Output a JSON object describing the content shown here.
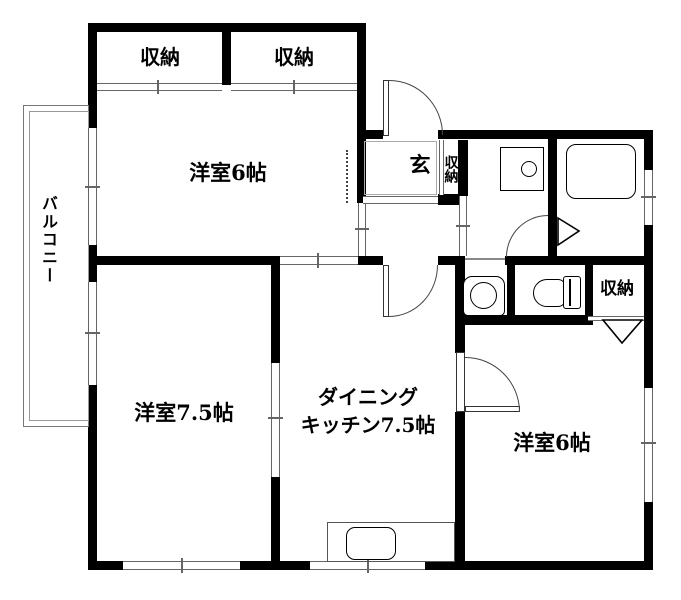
{
  "title": "apartment-floor-plan",
  "rooms": {
    "closet_top_1": "収納",
    "closet_top_2": "収納",
    "western_room_6_top": "洋室6帖",
    "balcony": "バルコニー",
    "entrance": "玄",
    "entrance_closet": "収納",
    "western_room_7_5": "洋室7.5帖",
    "dining_kitchen_line1": "ダイニング",
    "dining_kitchen_line2": "キッチン7.5帖",
    "western_room_6_right": "洋室6帖",
    "closet_bottom_right": "収納"
  },
  "fixtures": [
    "bathtub-icon",
    "vanity-sink-icon",
    "washing-machine-icon",
    "toilet-icon",
    "kitchen-sink-icon"
  ],
  "colors": {
    "wall": "#000000",
    "thin_line": "#666666",
    "background": "#ffffff",
    "text": "#000000"
  }
}
